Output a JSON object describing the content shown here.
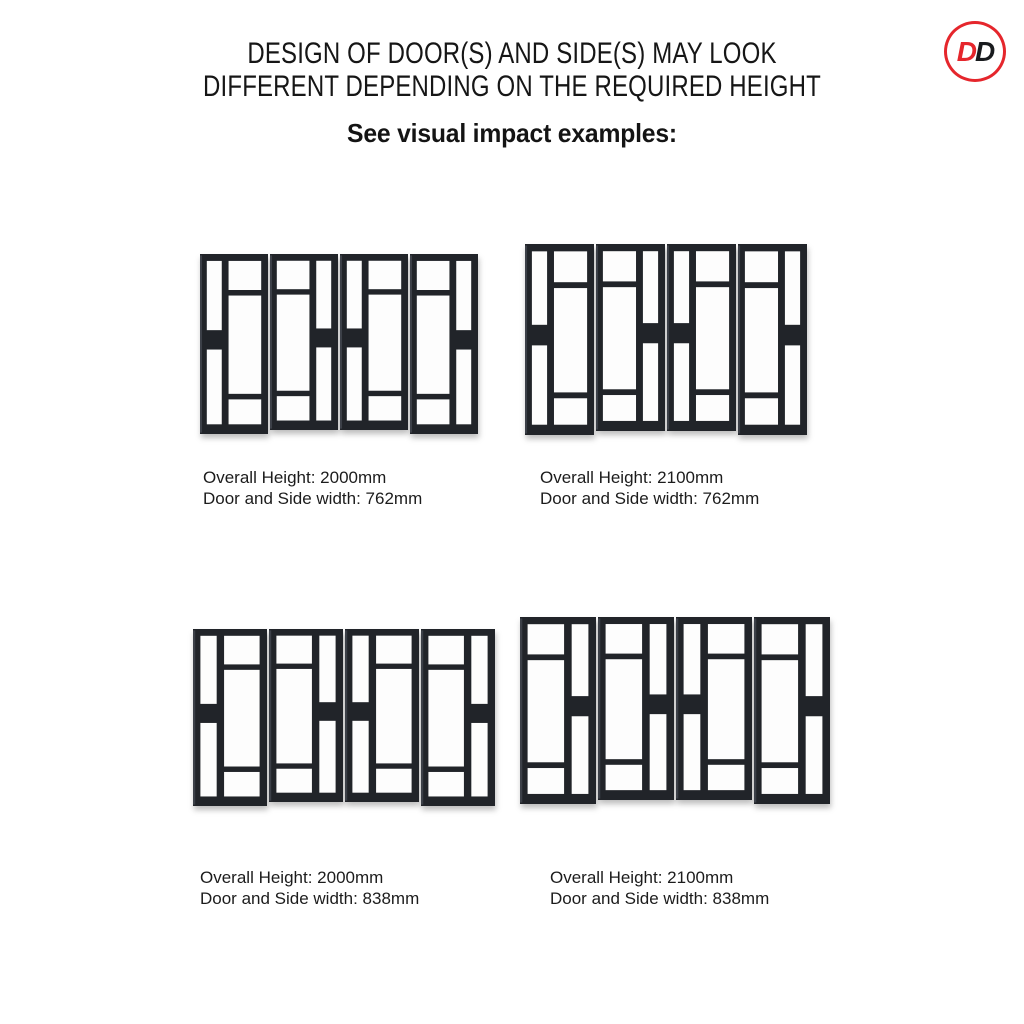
{
  "header": {
    "title_line1": "DESIGN OF DOOR(S) AND SIDE(S) MAY LOOK",
    "title_line2": "DIFFERENT DEPENDING ON THE REQUIRED HEIGHT",
    "subtitle": "See visual impact examples:"
  },
  "logo": {
    "letter1": "D",
    "letter2": "D",
    "ring_color": "#e5262c",
    "letter1_color": "#e5262c",
    "letter2_color": "#191b1e"
  },
  "colors": {
    "frame": "#212429",
    "frame_highlight": "#3c4048",
    "glass": "#fdfdfd",
    "text": "#1c1c1c"
  },
  "examples": [
    {
      "caption_line1": "Overall Height: 2000mm",
      "caption_line2": "Door and Side width: 762mm",
      "overall_height_mm": "2000",
      "door_and_side_width_mm": "762",
      "panels": [
        "normal",
        "mirrored",
        "normal",
        "mirrored"
      ]
    },
    {
      "caption_line1": "Overall Height: 2100mm",
      "caption_line2": "Door and Side width: 762mm",
      "overall_height_mm": "2100",
      "door_and_side_width_mm": "762",
      "panels": [
        "normal",
        "mirrored",
        "normal",
        "mirrored"
      ]
    },
    {
      "caption_line1": "Overall Height: 2000mm",
      "caption_line2": "Door and Side width: 838mm",
      "overall_height_mm": "2000",
      "door_and_side_width_mm": "838",
      "panels": [
        "normal",
        "mirrored",
        "normal",
        "mirrored"
      ]
    },
    {
      "caption_line1": "Overall Height: 2100mm",
      "caption_line2": "Door and Side width: 838mm",
      "overall_height_mm": "2100",
      "door_and_side_width_mm": "838",
      "panels": [
        "mirrored",
        "mirrored",
        "normal",
        "mirrored"
      ]
    }
  ]
}
